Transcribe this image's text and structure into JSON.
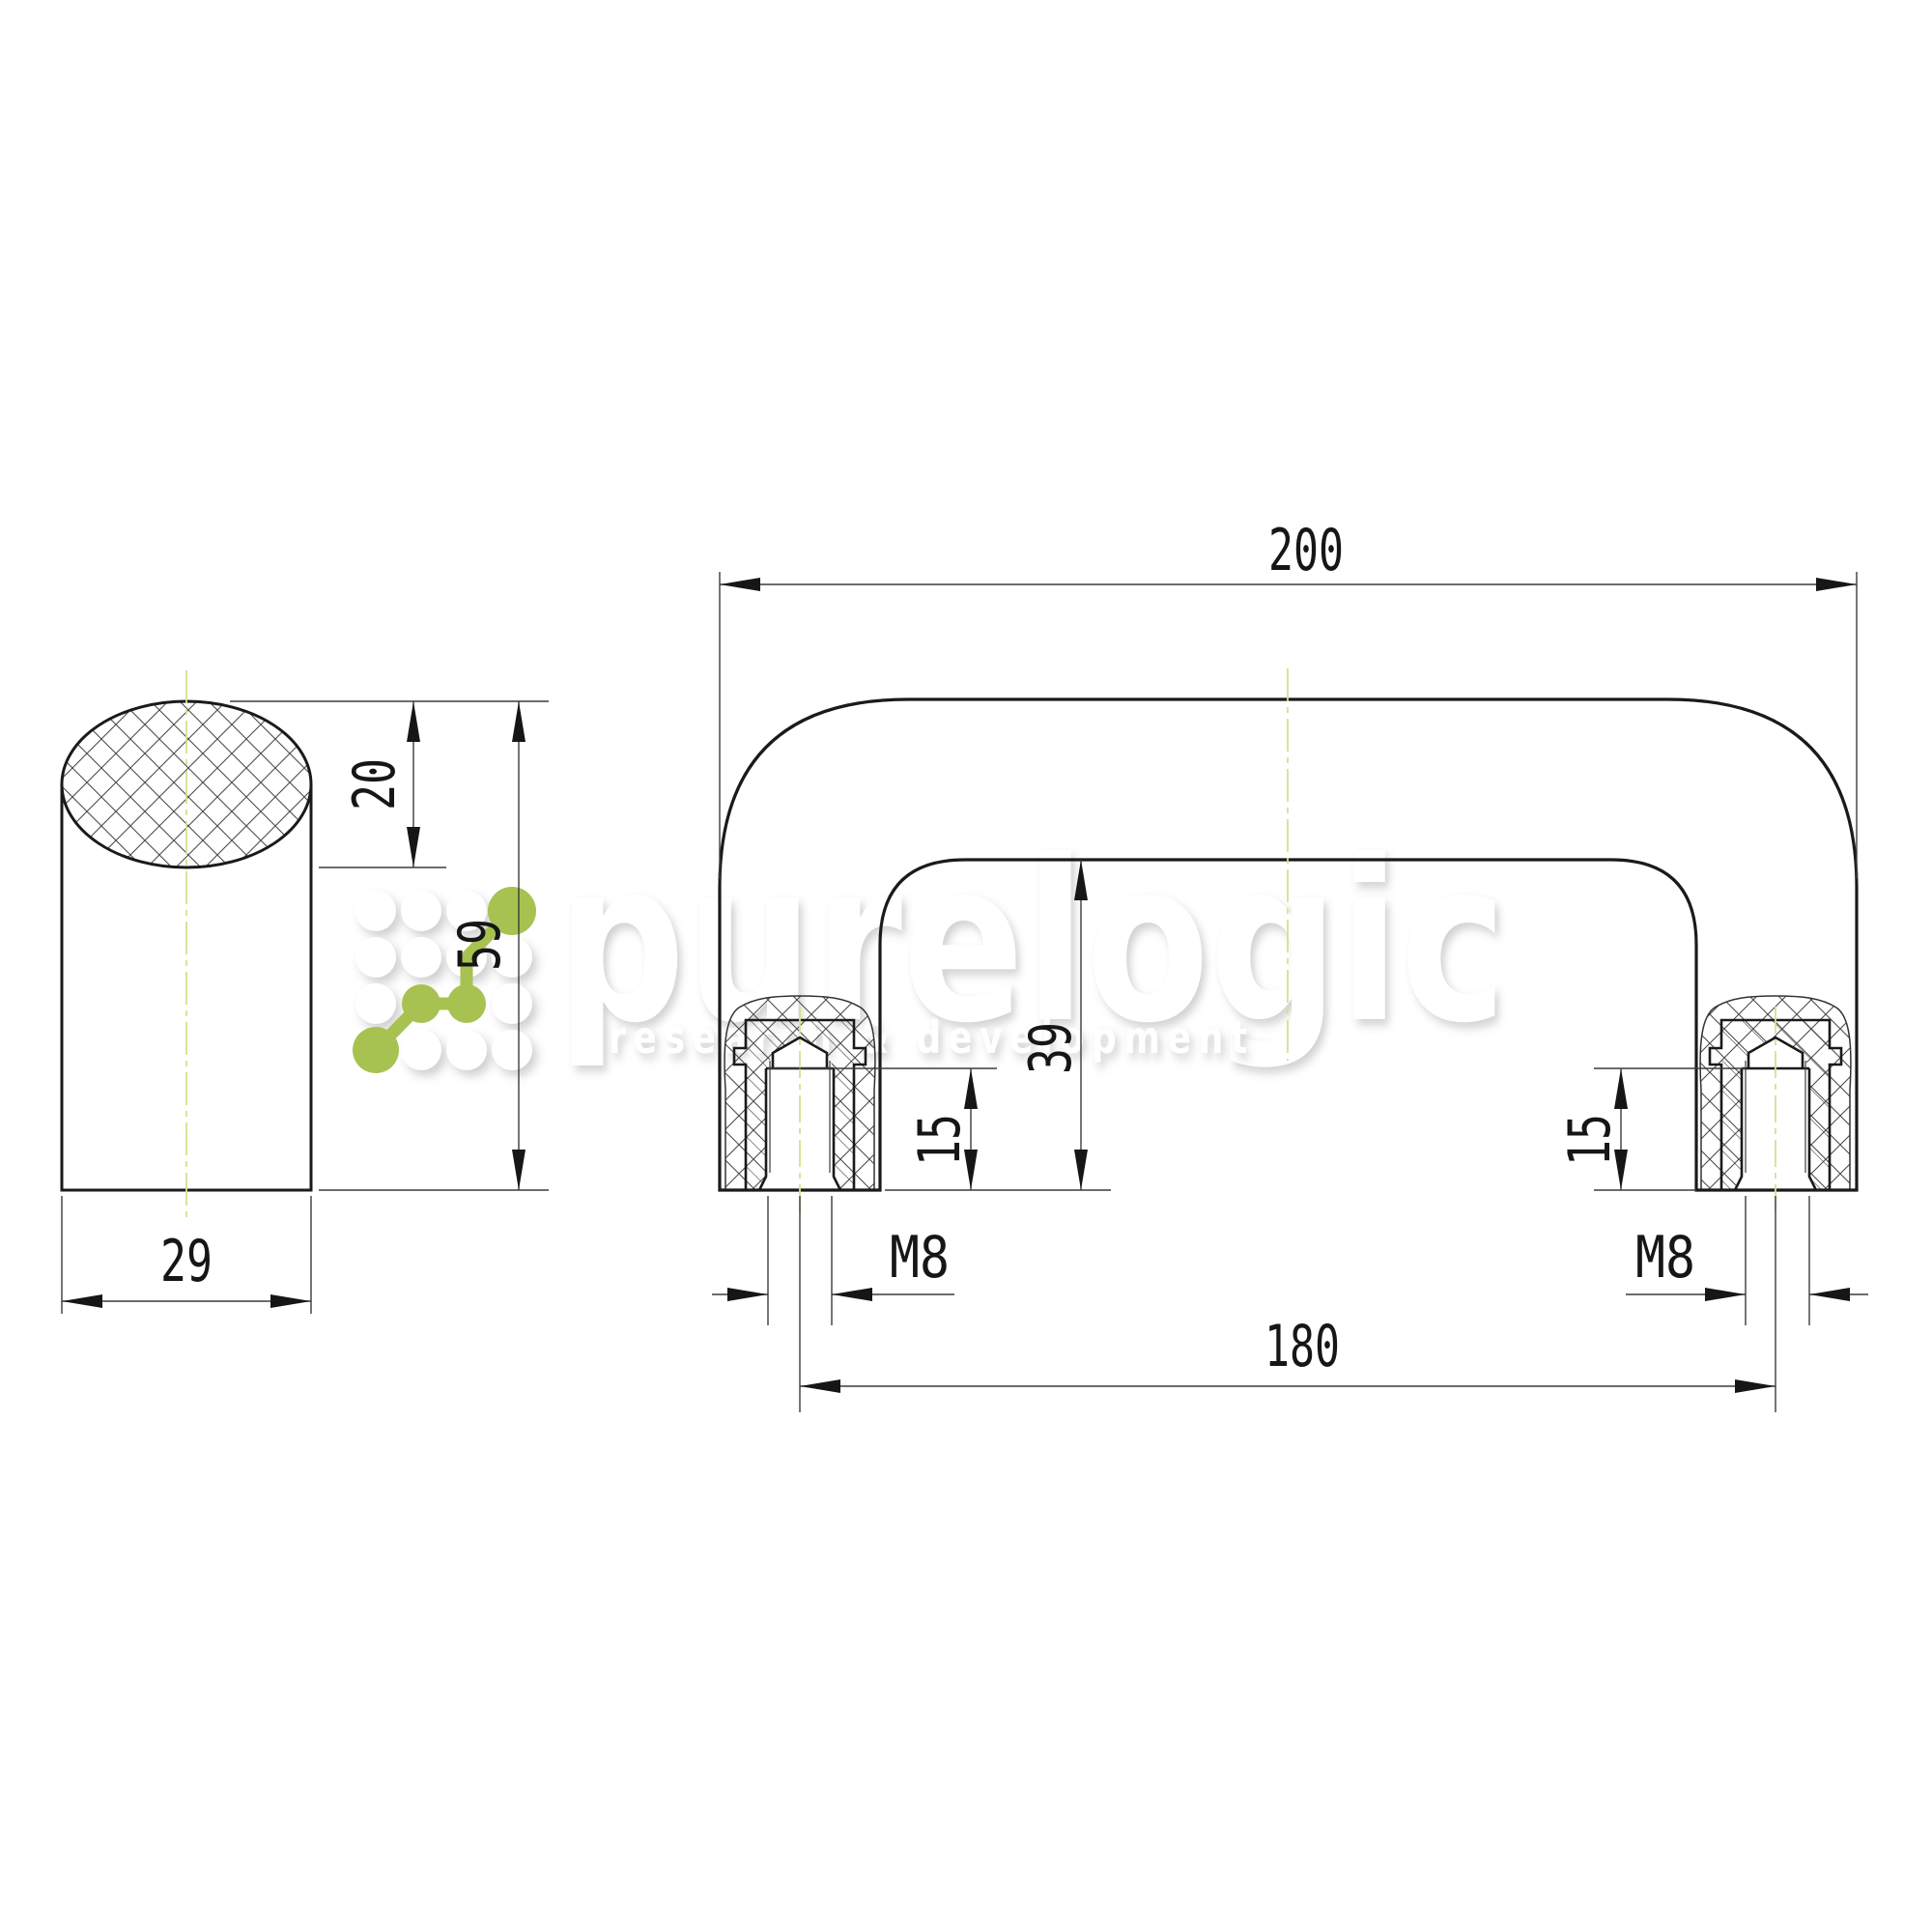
{
  "watermark": {
    "brand": "purelogic",
    "tagline": "research & development"
  },
  "logo": {
    "name": "purelogic-dots-logo",
    "green": "#a7c250"
  },
  "drawing": {
    "side_view": {
      "width": "29",
      "height": "59",
      "grip_section_height": "20"
    },
    "front_view": {
      "overall_width": "200",
      "mount_hole_spacing": "180",
      "inner_height": "39",
      "thread_depth": "15",
      "thread_size": "M8"
    }
  },
  "colors": {
    "outline": "#1a1a1a",
    "dim_line": "#3c3c3c",
    "hatch": "#4a4a4a",
    "centerline": "#d6e28c",
    "watermark_white": "#ffffff",
    "logo_green": "#a7c250"
  }
}
